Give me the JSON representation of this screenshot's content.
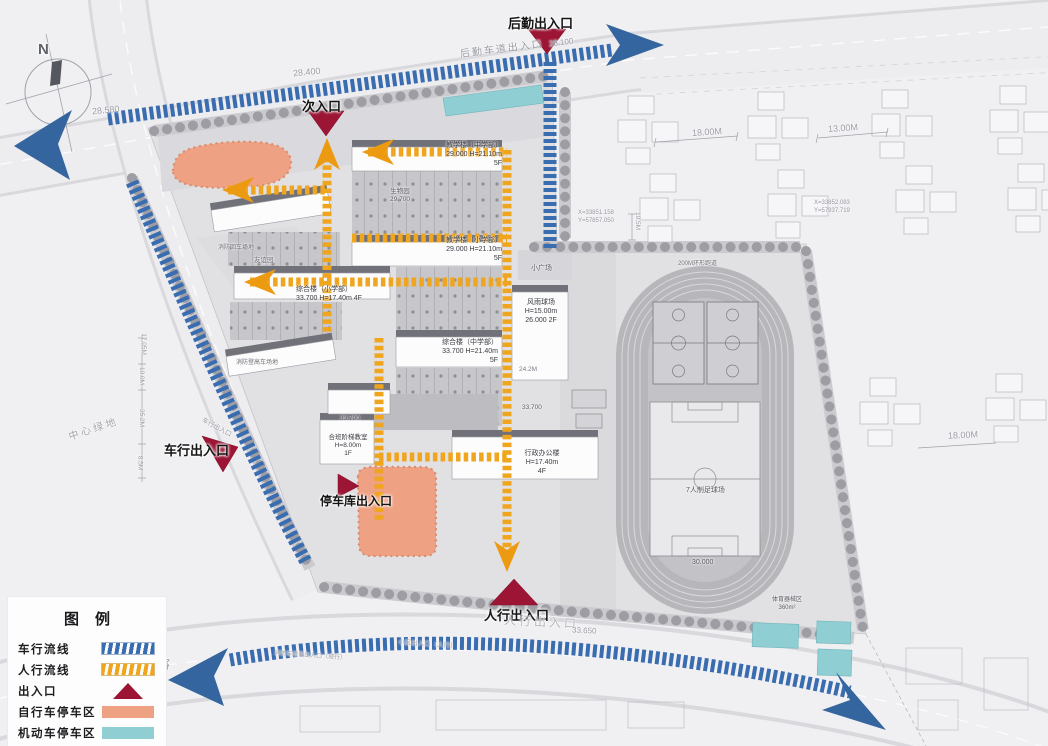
{
  "legend": {
    "title": "图例",
    "items": [
      {
        "label": "车行流线",
        "swatch": "vehicle-flow",
        "color": "#3a6cb0"
      },
      {
        "label": "人行流线",
        "swatch": "pedestrian-flow",
        "color": "#f0a51e"
      },
      {
        "label": "出入口",
        "swatch": "entrance",
        "color": "#9c1535"
      },
      {
        "label": "自行车停车区",
        "swatch": "bike-parking",
        "color": "#efa183"
      },
      {
        "label": "机动车停车区",
        "swatch": "motor-parking",
        "color": "#8fced2"
      }
    ]
  },
  "labels": [
    {
      "n": "label-houqin-entrance",
      "t": "后勤出入口",
      "x": 508,
      "y": 16,
      "s": 13,
      "b": 1
    },
    {
      "n": "label-ci-entrance",
      "t": "次入口",
      "x": 302,
      "y": 99,
      "s": 13,
      "b": 1
    },
    {
      "n": "label-chexing-entrance",
      "t": "车行出入口",
      "x": 164,
      "y": 443,
      "s": 13,
      "b": 1
    },
    {
      "n": "label-tingcheku-entrance",
      "t": "停车库出入口",
      "x": 320,
      "y": 494,
      "s": 12,
      "b": 1
    },
    {
      "n": "label-renxing-entrance",
      "t": "人行出入口",
      "x": 484,
      "y": 608,
      "s": 13,
      "b": 1
    },
    {
      "n": "road-label-houqin-lane",
      "t": "后勤车道出入口",
      "x": 460,
      "y": 44,
      "s": 10,
      "c": "#989aa2",
      "r": -7,
      "ls": 2
    },
    {
      "n": "elevation-28-100",
      "t": "28.100",
      "x": 549,
      "y": 38,
      "s": 8,
      "c": "#9a9ca4",
      "r": -7
    },
    {
      "n": "elevation-28-400",
      "t": "28.400",
      "x": 293,
      "y": 67,
      "s": 9,
      "c": "#9a9ca4",
      "r": -6
    },
    {
      "n": "elevation-28-580",
      "t": "28.580",
      "x": 92,
      "y": 105,
      "s": 9,
      "c": "#9a9ca4",
      "r": -6
    },
    {
      "n": "road-label-renxing",
      "t": "人行出入口",
      "x": 504,
      "y": 615,
      "s": 12,
      "c": "#b4b6bc",
      "r": 3,
      "ls": 3
    },
    {
      "n": "elevation-33-650",
      "t": "33.650",
      "x": 572,
      "y": 626,
      "s": 8,
      "c": "#9a9ca4",
      "r": 3
    },
    {
      "n": "label-central-green",
      "t": "中心绿地",
      "x": 68,
      "y": 424,
      "s": 10,
      "c": "#a2a4aa",
      "r": -18,
      "ls": 3
    },
    {
      "n": "road-name-lu",
      "t": "路",
      "x": 157,
      "y": 656,
      "s": 13,
      "c": "#9a9ca4",
      "r": 12
    },
    {
      "n": "road-label-xiaoqu-entrance",
      "t": "小区出入口（人行）",
      "x": 398,
      "y": 641,
      "s": 6.5,
      "c": "#9a9ca4",
      "r": 4
    },
    {
      "n": "road-label-xiaofang-lane",
      "t": "消防车道兼出入口（坡行）",
      "x": 274,
      "y": 653,
      "s": 6,
      "c": "#9a9ca4",
      "r": 4
    },
    {
      "n": "coords-northwest",
      "t": "X=33851.158\nY=57857.050",
      "x": 578,
      "y": 210,
      "s": 6,
      "c": "#94969e"
    },
    {
      "n": "coords-northeast",
      "t": "X=33852.083\nY=57937.719",
      "x": 814,
      "y": 200,
      "s": 6,
      "c": "#94969e"
    },
    {
      "n": "bldg-label-teaching-upper",
      "t": "教学楼（中学部）\n29.000  H=21.10m\n5F",
      "x": 430,
      "y": 142,
      "s": 7,
      "c": "#3a3c42",
      "ta": "right",
      "w": 72
    },
    {
      "n": "bldg-label-teaching-lower",
      "t": "教学楼（小学部）\n29.000  H=21.10m\n5F",
      "x": 430,
      "y": 237,
      "s": 7,
      "c": "#3a3c42",
      "ta": "right",
      "w": 72
    },
    {
      "n": "bldg-label-zonghe-primary",
      "t": "综合楼（小学部）\n33.700  H=17.40m 4F",
      "x": 296,
      "y": 286,
      "s": 7,
      "c": "#3a3c42",
      "w": 80
    },
    {
      "n": "bldg-label-zonghe-middle",
      "t": "综合楼（中学部）\n33.700  H=21.40m\n5F",
      "x": 430,
      "y": 339,
      "s": 7,
      "c": "#3a3c42",
      "ta": "right",
      "w": 68
    },
    {
      "n": "bldg-label-fengyu-court",
      "t": "风雨球场\nH=15.00m\n26.000 2F",
      "x": 518,
      "y": 299,
      "s": 7,
      "c": "#3a3c42",
      "ta": "center",
      "w": 46
    },
    {
      "n": "bldg-label-heban-classroom",
      "t": "合班阶梯教室\nH=8.00m\n1F",
      "x": 322,
      "y": 434,
      "s": 6.5,
      "c": "#3a3c42",
      "ta": "center",
      "w": 52
    },
    {
      "n": "elevation-33-700-heban",
      "t": "33.700",
      "x": 340,
      "y": 415,
      "s": 6.5,
      "c": "#5a5c62"
    },
    {
      "n": "bldg-label-admin",
      "t": "行政办公楼\nH=17.40m\n4F",
      "x": 518,
      "y": 450,
      "s": 7,
      "c": "#3a3c42",
      "ta": "center",
      "w": 48
    },
    {
      "n": "elevation-33-700-admin",
      "t": "33.700",
      "x": 522,
      "y": 404,
      "s": 6.5,
      "c": "#5a5c62"
    },
    {
      "n": "label-biology-garden",
      "t": "生物园\n29.700",
      "x": 382,
      "y": 188,
      "s": 6.5,
      "c": "#5a5c62",
      "ta": "center",
      "w": 36
    },
    {
      "n": "label-friendship-garden",
      "t": "友谊园",
      "x": 254,
      "y": 257,
      "s": 6.5,
      "c": "#6e7076"
    },
    {
      "n": "label-fire-turnaround",
      "t": "消防回车场地",
      "x": 218,
      "y": 245,
      "s": 6,
      "c": "#6e7076"
    },
    {
      "n": "label-fire-ladder-area",
      "t": "消防登高车场地",
      "x": 236,
      "y": 360,
      "s": 6,
      "c": "#6e7076"
    },
    {
      "n": "label-small-plaza",
      "t": "小广场",
      "x": 531,
      "y": 265,
      "s": 7,
      "c": "#55575e"
    },
    {
      "n": "label-ring-track",
      "t": "200M环形跑道",
      "x": 678,
      "y": 261,
      "s": 6,
      "c": "#6e7076"
    },
    {
      "n": "label-football-field",
      "t": "7人制足球场",
      "x": 686,
      "y": 487,
      "s": 7,
      "c": "#55575e"
    },
    {
      "n": "elevation-30-000",
      "t": "30.000",
      "x": 692,
      "y": 559,
      "s": 7,
      "c": "#55575e"
    },
    {
      "n": "label-sports-equipment",
      "t": "体育器械区\n360m²",
      "x": 766,
      "y": 597,
      "s": 6,
      "c": "#55575e",
      "ta": "center",
      "w": 42
    },
    {
      "n": "dim-24-2m",
      "t": "24.2M",
      "x": 519,
      "y": 366,
      "s": 6.5,
      "c": "#7a7c84"
    },
    {
      "n": "dim-18m-top",
      "t": "18.00M",
      "x": 692,
      "y": 127,
      "s": 9,
      "c": "#9a9ca4",
      "r": -4
    },
    {
      "n": "dim-13m-top",
      "t": "13.00M",
      "x": 828,
      "y": 123,
      "s": 9,
      "c": "#9a9ca4",
      "r": -4
    },
    {
      "n": "dim-18m-right",
      "t": "18.00M",
      "x": 948,
      "y": 430,
      "s": 9,
      "c": "#9a9ca4",
      "r": -3
    },
    {
      "n": "dim-10-5m",
      "t": "10.5M",
      "x": 628,
      "y": 217,
      "s": 6.5,
      "c": "#9a9ca4",
      "r": 90
    },
    {
      "n": "dim-17-05m",
      "t": "17.05M",
      "x": 132,
      "y": 340,
      "s": 6.5,
      "c": "#9a9ca4",
      "r": 90
    },
    {
      "n": "dim-10-0m",
      "t": "10.0M",
      "x": 132,
      "y": 372,
      "s": 6.5,
      "c": "#9a9ca4",
      "r": 90
    },
    {
      "n": "dim-35-2m",
      "t": "35.2M",
      "x": 132,
      "y": 414,
      "s": 6.5,
      "c": "#9a9ca4",
      "r": 90
    },
    {
      "n": "dim-8-5m",
      "t": "8.5M",
      "x": 132,
      "y": 459,
      "s": 6.5,
      "c": "#9a9ca4",
      "r": 90
    },
    {
      "n": "road-label-chexing-small",
      "t": "车行出入口",
      "x": 200,
      "y": 424,
      "s": 6.5,
      "c": "#9a9ca4",
      "r": 28
    },
    {
      "n": "compass-n-letter",
      "t": "N",
      "x": 38,
      "y": 41,
      "s": 15,
      "c": "#5f616a",
      "b": 1
    }
  ]
}
